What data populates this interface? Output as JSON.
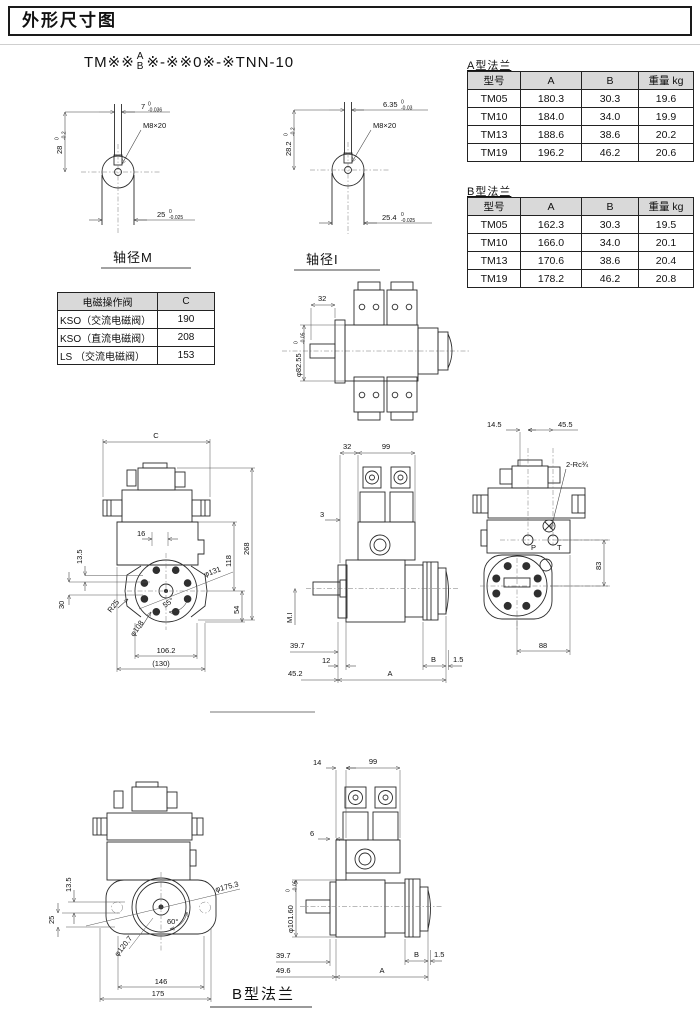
{
  "colors": {
    "ink": "#1a1a1a",
    "table_header_bg": "#d9d9d9",
    "paper": "#ffffff"
  },
  "page": {
    "title": "外形尺寸图",
    "bottom_caption": "B型法兰"
  },
  "model_code": {
    "prefix": "TM※※",
    "stack_top": "A",
    "stack_bottom": "B",
    "suffix": "※-※※0※-※TNN-10"
  },
  "shaft_m": {
    "caption": "轴径M",
    "thread": "M8×20",
    "key_width": "7",
    "key_width_tol_top": "0",
    "key_width_tol_bot": "-0.036",
    "height": "28",
    "height_tol_top": "0",
    "height_tol_bot": "-0.2",
    "dia": "25",
    "dia_tol_top": "0",
    "dia_tol_bot": "-0.025"
  },
  "shaft_i": {
    "caption": "轴径I",
    "thread": "M8×20",
    "key_width": "6.35",
    "key_width_tol_top": "0",
    "key_width_tol_bot": "-0.03",
    "height": "28.2",
    "height_tol_top": "0",
    "height_tol_bot": "-0.2",
    "dia": "25.4",
    "dia_tol_top": "0",
    "dia_tol_bot": "-0.025"
  },
  "flange_a": {
    "caption": "A型法兰",
    "headers": [
      "型号",
      "A",
      "B",
      "重量 kg"
    ],
    "rows": [
      [
        "TM05",
        "180.3",
        "30.3",
        "19.6"
      ],
      [
        "TM10",
        "184.0",
        "34.0",
        "19.9"
      ],
      [
        "TM13",
        "188.6",
        "38.6",
        "20.2"
      ],
      [
        "TM19",
        "196.2",
        "46.2",
        "20.6"
      ]
    ]
  },
  "flange_b": {
    "caption": "B型法兰",
    "headers": [
      "型号",
      "A",
      "B",
      "重量 kg"
    ],
    "rows": [
      [
        "TM05",
        "162.3",
        "30.3",
        "19.5"
      ],
      [
        "TM10",
        "166.0",
        "34.0",
        "20.1"
      ],
      [
        "TM13",
        "170.6",
        "38.6",
        "20.4"
      ],
      [
        "TM19",
        "178.2",
        "46.2",
        "20.8"
      ]
    ]
  },
  "valve_table": {
    "headers": [
      "电磁操作阀",
      "C"
    ],
    "rows": [
      [
        "KSO（交流电磁阀）",
        "190"
      ],
      [
        "KSO（直流电磁阀）",
        "208"
      ],
      [
        "LS （交流电磁阀）",
        "153"
      ]
    ]
  },
  "top_view": {
    "dim_width": "32",
    "dia": "φ82.55",
    "dia_tol_top": "0",
    "dia_tol_bot": "-0.05"
  },
  "front_a": {
    "dim_c": "C",
    "dim_16": "16",
    "dim_268": "268",
    "dim_118": "118",
    "dim_54": "54",
    "dim_13_5": "13.5",
    "dim_30": "30",
    "r25": "R25",
    "d108": "φ108",
    "d131": "φ131",
    "angle": "55°",
    "dim_106_2": "106.2",
    "dim_130": "(130)"
  },
  "side_a": {
    "dim_32": "32",
    "dim_99": "99",
    "dim_3": "3",
    "m_i": "M.I",
    "dim_39_7": "39.7",
    "dim_12": "12",
    "dim_45_2": "45.2",
    "dim_a": "A",
    "dim_b": "B",
    "dim_1_5": "1.5"
  },
  "rear": {
    "dim_14_5": "14.5",
    "dim_45_5": "45.5",
    "port_thread": "2-Rc¾",
    "p": "P",
    "t": "T",
    "dim_83": "83",
    "dim_88": "88"
  },
  "front_b": {
    "dim_13_5": "13.5",
    "dim_25": "25",
    "d175_3": "φ175.3",
    "d120_7": "φ120.7",
    "angle": "60°",
    "dim_146": "146",
    "dim_175": "175"
  },
  "side_b": {
    "dim_14": "14",
    "dim_99": "99",
    "dim_6": "6",
    "dia": "φ101.60",
    "dia_tol_top": "0",
    "dia_tol_bot": "-0.05",
    "dim_39_7": "39.7",
    "dim_49_6": "49.6",
    "dim_a": "A",
    "dim_b": "B",
    "dim_1_5": "1.5"
  }
}
